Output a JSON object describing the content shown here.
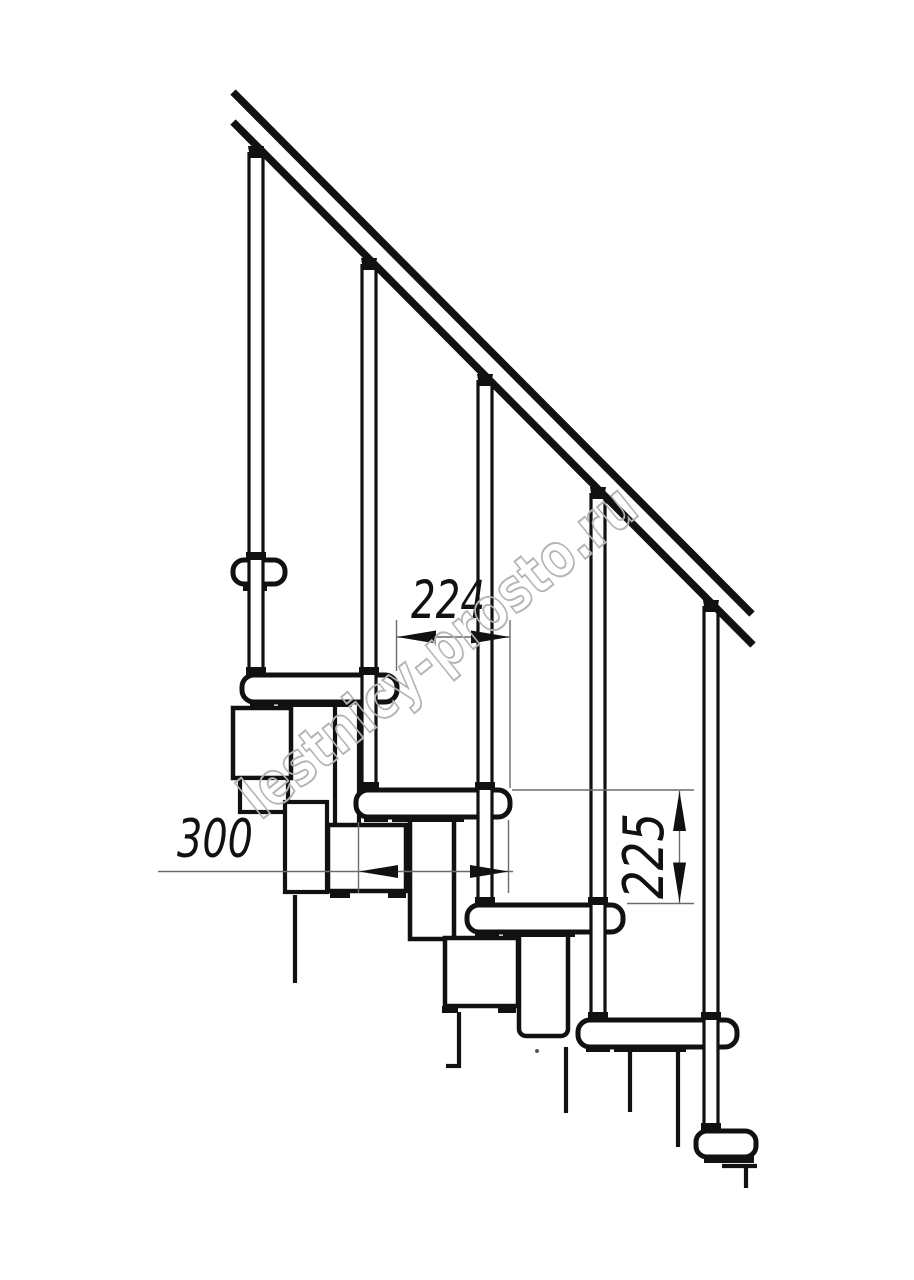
{
  "drawing": {
    "title_hint": "modular staircase side-view fragment",
    "dimensions": {
      "step_run_label": "224",
      "tread_length_label": "300",
      "step_height_label": "225"
    },
    "watermark": {
      "text": "lestnicy-prosto.ru"
    }
  },
  "colors": {
    "ink": "#111111",
    "dim": "#6b6b6b",
    "wm": "#b4b4b4",
    "bg": "#ffffff"
  }
}
